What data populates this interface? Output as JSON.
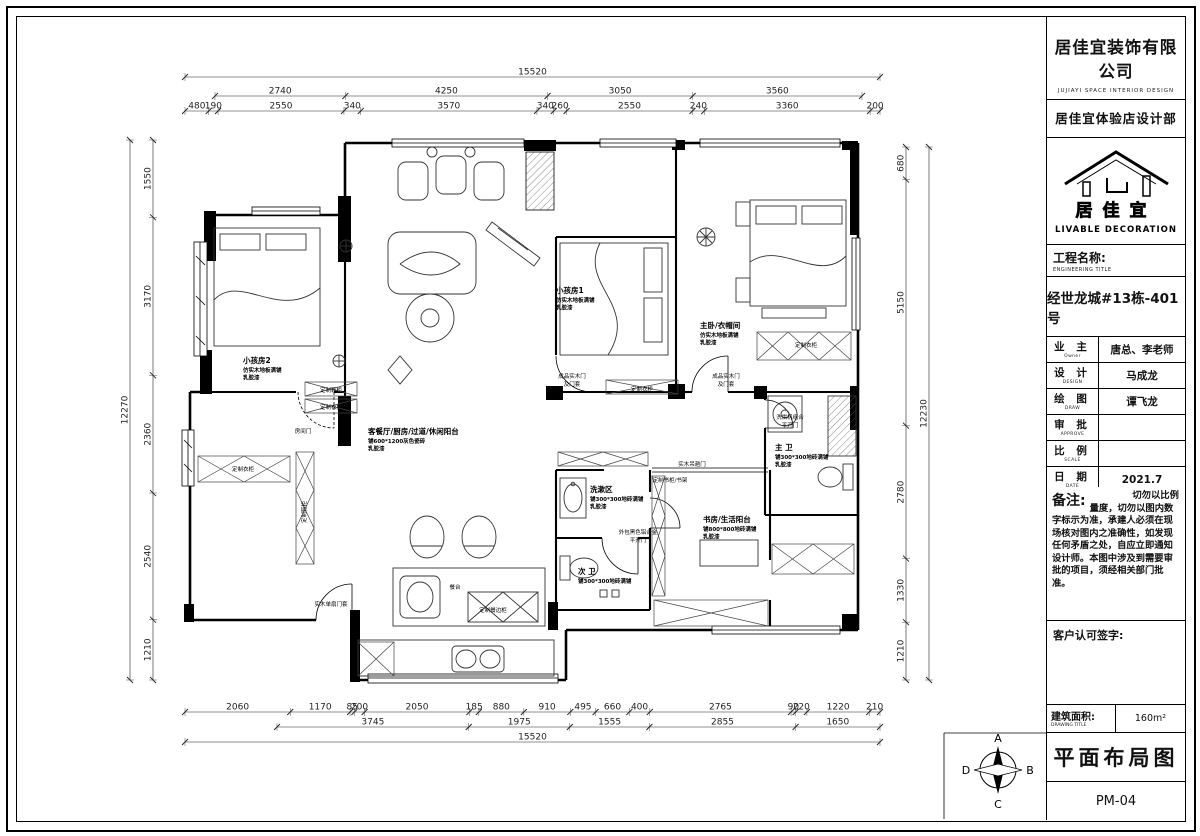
{
  "title_block": {
    "company": "居佳宜装饰有限公司",
    "company_en": "JUJIAYI  SPACE  INTERIOR  DESIGN",
    "department": "居佳宜体验店设计部",
    "logo_name": "居佳宜",
    "logo_tagline": "LIVABLE DECORATION",
    "engineering_title_label": "工程名称:",
    "engineering_title_en": "ENGINEERING TITLE",
    "project_name": "经世龙城#13栋-401号",
    "rows": [
      {
        "label": "业  主",
        "label_en": "Owner",
        "value": "唐总、李老师"
      },
      {
        "label": "设  计",
        "label_en": "DESIGN",
        "value": "马成龙"
      },
      {
        "label": "绘  图",
        "label_en": "DRAW",
        "value": "谭飞龙"
      },
      {
        "label": "审  批",
        "label_en": "APPROVE",
        "value": ""
      },
      {
        "label": "比  例",
        "label_en": "SCALE",
        "value": ""
      },
      {
        "label": "日  期",
        "label_en": "DATE",
        "value": "2021.7"
      }
    ],
    "notes_label": "备注:",
    "notes_text": "切勿以比例量度，切勿以图内数字标示为准，承建人必须在现场核对图内之准确性，如发现任何矛盾之处，自应立即通知设计师。本图中涉及到需要审批的项目，须经相关部门批准。",
    "signature_label": "客户认可签字:",
    "area_label": "建筑面积:",
    "area_label_en": "DRAWING TITLE",
    "area_value": "160m²",
    "drawing_title": "平面布局图",
    "drawing_no": "PM-04"
  },
  "compass": {
    "n": "A",
    "e": "B",
    "s": "C",
    "w": "D"
  },
  "plan": {
    "dims": {
      "top": [
        [
          15520
        ],
        [
          2740,
          4250,
          3050,
          3560
        ],
        [
          480,
          190,
          2550,
          340,
          3570,
          340,
          260,
          2550,
          240,
          3360,
          200
        ]
      ],
      "bottom": [
        [
          2060,
          1170,
          85,
          200,
          2050,
          185,
          880,
          910,
          495,
          660,
          400,
          2765,
          90,
          220,
          1220,
          210
        ],
        [
          3745,
          1975,
          1555,
          2855,
          1650
        ],
        [
          15520
        ]
      ],
      "left": [
        [
          12270
        ],
        [
          1550,
          3170,
          2360,
          2540,
          1210
        ]
      ],
      "right": [
        [
          680,
          5150,
          2780,
          1330,
          1210
        ],
        [
          12230
        ]
      ]
    },
    "room_labels": [
      {
        "x": 243,
        "y": 363,
        "lines": [
          "小孩房2",
          "仿实木地板满铺",
          "乳胶漆"
        ]
      },
      {
        "x": 556,
        "y": 293,
        "lines": [
          "小孩房1",
          "仿实木地板满铺",
          "乳胶漆"
        ]
      },
      {
        "x": 700,
        "y": 328,
        "lines": [
          "主卧/衣帽间",
          "仿实木地板满铺",
          "乳胶漆"
        ]
      },
      {
        "x": 368,
        "y": 434,
        "lines": [
          "客餐厅/厨房/过道/休闲阳台",
          "铺600*1200灰色瓷砖",
          "乳胶漆"
        ]
      },
      {
        "x": 775,
        "y": 450,
        "lines": [
          "主 卫",
          "铺300*300地砖满铺",
          "乳胶漆"
        ]
      },
      {
        "x": 590,
        "y": 492,
        "lines": [
          "洗漱区",
          "铺300*300地砖满铺",
          "乳胶漆"
        ]
      },
      {
        "x": 703,
        "y": 522,
        "lines": [
          "书房/生活阳台",
          "铺800*800地砖满铺",
          "乳胶漆"
        ]
      },
      {
        "x": 578,
        "y": 574,
        "lines": [
          "次 卫",
          "铺300*300地砖满铺"
        ]
      }
    ],
    "annotations": [
      {
        "x": 331,
        "y": 392,
        "t": "定制鞋柜"
      },
      {
        "x": 331,
        "y": 409,
        "t": "定制衣柜"
      },
      {
        "x": 303,
        "y": 433,
        "t": "房间门"
      },
      {
        "x": 243,
        "y": 471,
        "t": "定制衣柜"
      },
      {
        "x": 306,
        "y": 512,
        "t": "定制鞋柜",
        "rot": -90
      },
      {
        "x": 331,
        "y": 606,
        "t": "实木单扇门套"
      },
      {
        "x": 572,
        "y": 378,
        "t": "成品实木门"
      },
      {
        "x": 572,
        "y": 386,
        "t": "及门套"
      },
      {
        "x": 642,
        "y": 391,
        "t": "定制衣柜"
      },
      {
        "x": 726,
        "y": 378,
        "t": "成品实木门"
      },
      {
        "x": 726,
        "y": 386,
        "t": "及门套"
      },
      {
        "x": 806,
        "y": 347,
        "t": "定制衣柜"
      },
      {
        "x": 790,
        "y": 419,
        "t": "洗烘机组合"
      },
      {
        "x": 790,
        "y": 427,
        "t": "平开门"
      },
      {
        "x": 670,
        "y": 482,
        "t": "定制书柜/书架"
      },
      {
        "x": 638,
        "y": 534,
        "t": "外包黑色铝合金"
      },
      {
        "x": 638,
        "y": 542,
        "t": "平开门"
      },
      {
        "x": 692,
        "y": 466,
        "t": "实木吊趟门"
      },
      {
        "x": 455,
        "y": 589,
        "t": "餐台"
      },
      {
        "x": 493,
        "y": 612,
        "t": "定制餐边柜"
      }
    ]
  }
}
